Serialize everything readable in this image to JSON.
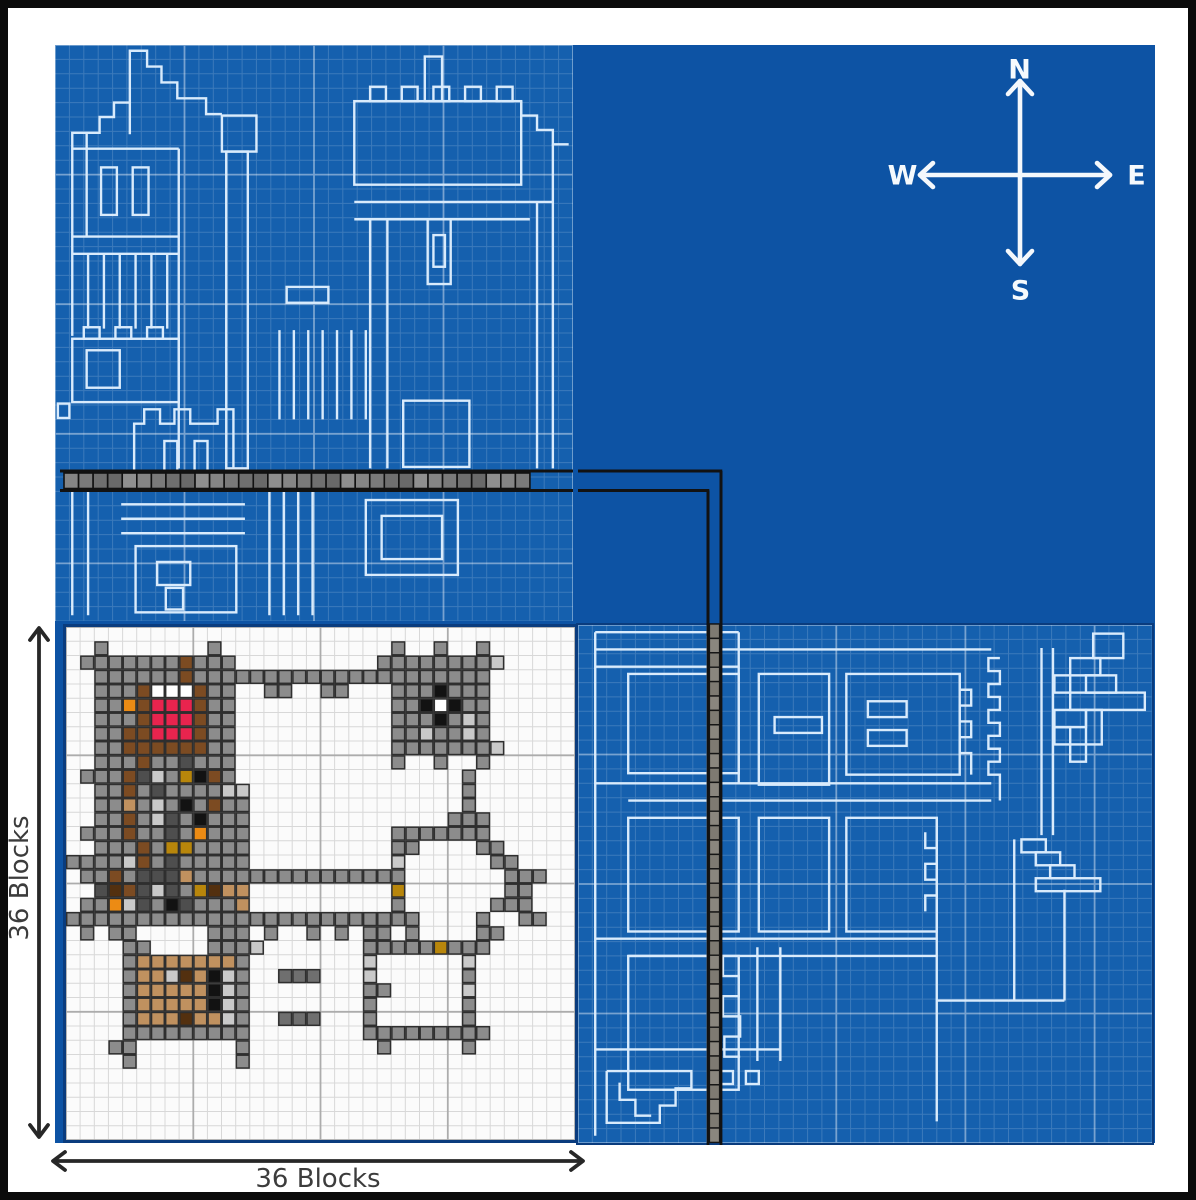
{
  "compass": {
    "north": "N",
    "east": "E",
    "south": "S",
    "west": "W"
  },
  "dimensions": {
    "left": "36 Blocks",
    "bottom": "36 Blocks"
  },
  "colors": {
    "frame": "#0b0b0b",
    "margin": "#ffffff",
    "canvas_blue": "#0d53a4",
    "panel_blue": "#1560ae",
    "grid_minor": "rgba(255,255,255,0.17)",
    "grid_major": "rgba(255,255,255,0.42)",
    "blueprint_line": "#d9ebfc",
    "panel_border": "#0a3c7e",
    "plan_bg": "#fbfbfb",
    "plan_grid_minor": "#d8d8d8",
    "plan_grid_major": "#acacac",
    "cell_outline": "#2f2f2f",
    "walkway_line": "#121212",
    "walkway_grays": [
      "#858585",
      "#6f6f6f",
      "#8f8f8f",
      "#7a7a7a",
      "#696969"
    ],
    "walkway_grays_v": [
      "#7e7a72",
      "#6e6a62",
      "#8a867e",
      "#76726a"
    ],
    "arrow": "#272727",
    "label_text": "#3c3c3c",
    "compass_stroke": "#f4f8fc"
  },
  "plan": {
    "cols": 36,
    "rows": 36,
    "major_every": 9,
    "palette": {
      "g": "#8c8c8c",
      "G": "#6f6f6f",
      "l": "#c9c9c9",
      "d": "#4e4e4e",
      "k": "#121212",
      "W": "#ffffff",
      "r": "#e8244e",
      "b": "#7c4b22",
      "m": "#53300f",
      "t": "#c0915f",
      "o": "#ec8b14",
      "y": "#b8860b"
    },
    "rows_map": [
      "....................................",
      "..g.......g............g..g..g......",
      ".gggggggbggg..........ggggggggl.....",
      "..ggggggbggggggggggggggggggggg......",
      "..gggbWWWbgg..gg..gg...gggkggg......",
      "..ggobrrrbgg...........ggkWkgg......",
      "..gggbrrrbgg...........gggkglg......",
      "..ggbbrrrbgg...........gglgglg......",
      "..ggbbbbbbgg...........gggggggl.....",
      "..gggbggdggg...........g..g..g......",
      ".gggbdlgykbg................g.......",
      "..ggbgdggggll...............g.......",
      "..ggtglgkgbgg...............g.......",
      "..ggbgldgkggg..............ggg......",
      ".gggbggdgoggg..........ggggggg......",
      "..gggbgyygggg..........gg....gg.....",
      "gggglbgdggggg..........l......gg....",
      ".ggbgdddtggggggggggggggg.......ggg..",
      "..dmbdldgymtt..........y.......gg...",
      ".ggoldgkdgggt..........g......ggg...",
      "ggggggggggggggggggggggggg....g..gg..",
      ".g.gg.....ggg.g..g.g.gg.g....gg.....",
      "....gg....gggl.......gggggyggg......",
      "....gtttttttg........l......l.......",
      "....gttlmtklg..GGG...l......g.......",
      "....gtttttklg........gg.....l.......",
      "....gtttttklg........g......g.......",
      "....gtttmttlg..GGG...g......g.......",
      "....ggggggggg........ggggggggg......",
      "...gg.......g.........g.....g.......",
      "....g.......g.......................",
      "....................................",
      "....................................",
      "....................................",
      "....................................",
      "...................................."
    ]
  },
  "walkway": {
    "horizontal_blocks": 32,
    "vertical_blocks": 36
  },
  "blueprint_top_left": {
    "cols": 36,
    "rows": 40,
    "major_every": 9,
    "shapes": [
      [
        "p",
        5.2,
        6.2,
        5.2,
        0.4,
        6.4,
        0.4,
        6.4,
        1.5,
        7.4,
        1.5,
        7.4,
        2.6,
        8.5,
        2.6,
        8.5,
        3.7,
        10.5,
        3.7,
        10.5,
        4.8,
        11.6,
        4.8
      ],
      [
        "p",
        5.2,
        4.0,
        4.1,
        4.0,
        4.1,
        5.0,
        3.1,
        5.0,
        3.1,
        6.1,
        1.2,
        6.1,
        1.2,
        20.2
      ],
      [
        "l",
        2.2,
        6.1,
        2.2,
        13.3
      ],
      [
        "l",
        1.2,
        7.2,
        8.6,
        7.2
      ],
      [
        "r",
        3.2,
        8.5,
        1.1,
        3.3
      ],
      [
        "r",
        5.4,
        8.5,
        1.1,
        3.3
      ],
      [
        "l",
        1.2,
        13.3,
        8.6,
        13.3
      ],
      [
        "l",
        1.2,
        14.5,
        8.6,
        14.5
      ],
      [
        "l",
        2.3,
        14.5,
        2.3,
        19.7
      ],
      [
        "l",
        3.4,
        14.5,
        3.4,
        19.7
      ],
      [
        "l",
        4.5,
        14.5,
        4.5,
        19.7
      ],
      [
        "l",
        5.6,
        14.5,
        5.6,
        19.7
      ],
      [
        "l",
        6.7,
        14.5,
        6.7,
        19.7
      ],
      [
        "l",
        7.8,
        14.5,
        7.8,
        19.7
      ],
      [
        "r",
        1.2,
        20.4,
        7.4,
        4.4
      ],
      [
        "r",
        2.2,
        21.2,
        2.3,
        2.6
      ],
      [
        "r",
        2.0,
        19.6,
        1.1,
        0.8
      ],
      [
        "r",
        4.2,
        19.6,
        1.1,
        0.8
      ],
      [
        "r",
        6.4,
        19.6,
        1.1,
        0.8
      ],
      [
        "l",
        8.6,
        7.2,
        8.6,
        29.4
      ],
      [
        "r",
        11.6,
        4.9,
        2.4,
        2.5
      ],
      [
        "r",
        11.9,
        7.4,
        1.5,
        22.0
      ],
      [
        "r",
        0.2,
        24.9,
        0.8,
        1.0
      ],
      [
        "p",
        5.5,
        29.6,
        5.5,
        26.3,
        6.2,
        26.3,
        6.2,
        25.3,
        7.3,
        25.3,
        7.3,
        26.3,
        8.3,
        26.3,
        8.3,
        25.3,
        9.4,
        25.3,
        9.4,
        26.3,
        11.3,
        26.3,
        11.3,
        25.3,
        12.4,
        25.3,
        12.4,
        29.6
      ],
      [
        "r",
        7.6,
        27.5,
        0.9,
        2.1
      ],
      [
        "r",
        9.7,
        27.5,
        0.9,
        2.1
      ],
      [
        "r",
        16.1,
        16.8,
        2.9,
        1.1
      ],
      [
        "l",
        15.6,
        19.8,
        15.6,
        26.0
      ],
      [
        "l",
        16.6,
        19.8,
        16.6,
        26.0
      ],
      [
        "l",
        17.6,
        19.8,
        17.6,
        26.0
      ],
      [
        "l",
        18.6,
        19.8,
        18.6,
        26.0
      ],
      [
        "l",
        19.6,
        19.8,
        19.6,
        26.0
      ],
      [
        "l",
        20.6,
        19.8,
        20.6,
        26.0
      ],
      [
        "l",
        21.6,
        19.8,
        21.6,
        26.0
      ],
      [
        "r",
        25.7,
        0.8,
        1.2,
        3.1
      ],
      [
        "r",
        20.8,
        3.9,
        11.6,
        5.8
      ],
      [
        "r",
        21.9,
        2.9,
        1.1,
        1.0
      ],
      [
        "r",
        24.1,
        2.9,
        1.1,
        1.0
      ],
      [
        "r",
        26.3,
        2.9,
        1.1,
        1.0
      ],
      [
        "r",
        28.5,
        2.9,
        1.1,
        1.0
      ],
      [
        "r",
        30.7,
        2.9,
        1.1,
        1.0
      ],
      [
        "p",
        32.4,
        3.9,
        32.4,
        4.9,
        33.5,
        4.9,
        33.5,
        5.9,
        34.6,
        5.9,
        34.6,
        6.9,
        35.7,
        6.9
      ],
      [
        "l",
        20.8,
        10.9,
        34.6,
        10.9
      ],
      [
        "l",
        20.8,
        12.1,
        33.0,
        12.1
      ],
      [
        "r",
        25.9,
        12.1,
        1.6,
        4.5
      ],
      [
        "r",
        26.3,
        13.2,
        0.8,
        2.2
      ],
      [
        "l",
        21.9,
        12.1,
        21.9,
        29.4
      ],
      [
        "l",
        23.1,
        12.1,
        23.1,
        29.4
      ],
      [
        "l",
        33.5,
        10.9,
        33.5,
        29.4
      ],
      [
        "l",
        34.6,
        6.9,
        34.6,
        29.4
      ],
      [
        "r",
        24.2,
        24.7,
        4.6,
        4.6
      ],
      [
        "l",
        1.2,
        30.9,
        1.2,
        39.6
      ],
      [
        "l",
        2.3,
        30.9,
        2.3,
        39.6
      ],
      [
        "l",
        4.6,
        31.9,
        13.2,
        31.9
      ],
      [
        "l",
        4.6,
        32.9,
        13.2,
        32.9
      ],
      [
        "l",
        4.6,
        33.9,
        13.2,
        33.9
      ],
      [
        "r",
        5.6,
        34.8,
        7.0,
        4.6
      ],
      [
        "r",
        7.1,
        35.9,
        2.3,
        1.6
      ],
      [
        "r",
        7.7,
        37.7,
        1.2,
        1.5
      ],
      [
        "l",
        14.9,
        30.9,
        14.9,
        39.6
      ],
      [
        "l",
        15.9,
        30.9,
        15.9,
        39.6
      ],
      [
        "l",
        16.9,
        30.9,
        16.9,
        39.6
      ],
      [
        "l",
        17.9,
        30.9,
        17.9,
        39.6
      ],
      [
        "r",
        21.6,
        31.6,
        6.4,
        5.2
      ],
      [
        "r",
        22.7,
        32.7,
        4.2,
        3.0
      ]
    ]
  },
  "blueprint_bottom_right": {
    "cols": 40,
    "rows": 36,
    "major_every": 9,
    "shapes": [
      [
        "l",
        1.2,
        0.5,
        1.2,
        35.5
      ],
      [
        "l",
        1.2,
        0.5,
        11.2,
        0.5
      ],
      [
        "l",
        1.2,
        1.7,
        28.8,
        1.7
      ],
      [
        "l",
        1.2,
        2.9,
        11.2,
        2.9
      ],
      [
        "r",
        3.5,
        3.4,
        7.7,
        6.9
      ],
      [
        "l",
        11.2,
        0.5,
        11.2,
        11.0
      ],
      [
        "r",
        12.6,
        3.4,
        4.9,
        7.7
      ],
      [
        "r",
        13.7,
        6.4,
        3.3,
        1.1
      ],
      [
        "r",
        18.7,
        3.4,
        7.9,
        7.0
      ],
      [
        "r",
        20.2,
        5.3,
        2.7,
        1.1
      ],
      [
        "r",
        20.2,
        7.3,
        2.7,
        1.1
      ],
      [
        "p",
        26.6,
        3.4,
        26.6,
        4.5,
        27.4,
        4.5,
        27.4,
        5.6,
        26.6,
        5.6,
        26.6,
        6.7,
        27.4,
        6.7,
        27.4,
        7.8,
        26.6,
        7.8,
        26.6,
        8.9,
        27.4,
        8.9,
        27.4,
        10.4
      ],
      [
        "l",
        1.2,
        11.0,
        28.8,
        11.0
      ],
      [
        "l",
        3.5,
        12.2,
        28.8,
        12.2
      ],
      [
        "r",
        3.5,
        13.4,
        7.7,
        7.9
      ],
      [
        "r",
        12.6,
        13.4,
        4.9,
        7.9
      ],
      [
        "r",
        18.7,
        13.4,
        6.3,
        7.9
      ],
      [
        "p",
        24.2,
        14.4,
        24.2,
        15.5,
        25.0,
        15.5,
        25.0,
        16.6,
        24.2,
        16.6,
        24.2,
        17.7,
        25.0,
        17.7,
        25.0,
        18.8,
        24.2,
        18.8,
        24.2,
        19.9
      ],
      [
        "l",
        1.2,
        21.8,
        25.0,
        21.8
      ],
      [
        "l",
        3.5,
        23.0,
        25.0,
        23.0
      ],
      [
        "r",
        3.5,
        23.0,
        7.7,
        9.3
      ],
      [
        "p",
        10.1,
        23.0,
        10.1,
        24.4,
        11.2,
        24.4,
        11.2,
        25.8,
        10.1,
        25.8,
        10.1,
        27.2,
        11.3,
        27.2,
        11.3,
        28.6,
        10.2,
        28.6,
        10.2,
        30.0,
        11.3,
        30.0
      ],
      [
        "l",
        12.5,
        22.4,
        12.5,
        30.3
      ],
      [
        "l",
        14.1,
        22.4,
        14.1,
        30.3
      ],
      [
        "l",
        1.2,
        29.5,
        14.1,
        29.5
      ],
      [
        "p",
        2.0,
        31.0,
        7.9,
        31.0,
        7.9,
        32.2,
        6.8,
        32.2,
        6.8,
        33.4,
        5.7,
        33.4,
        5.7,
        34.6,
        2.0,
        34.6,
        2.0,
        31.0
      ],
      [
        "p",
        2.9,
        31.8,
        2.9,
        33.0,
        4.0,
        33.0,
        4.0,
        34.1,
        5.1,
        34.1
      ],
      [
        "r",
        9.9,
        31.0,
        0.9,
        0.9
      ],
      [
        "r",
        11.7,
        31.0,
        0.9,
        0.9
      ],
      [
        "l",
        25.0,
        13.4,
        25.0,
        34.5
      ],
      [
        "l",
        25.0,
        26.1,
        33.9,
        26.1
      ],
      [
        "l",
        33.9,
        18.4,
        33.9,
        26.1
      ],
      [
        "p",
        29.4,
        2.3,
        28.6,
        2.3,
        28.6,
        3.2,
        29.4,
        3.2,
        29.4,
        4.1,
        28.6,
        4.1,
        28.6,
        5.0,
        29.4,
        5.0,
        29.4,
        5.9,
        28.6,
        5.9,
        28.6,
        6.8,
        29.4,
        6.8,
        29.4,
        7.7,
        28.6,
        7.7,
        28.6,
        8.6,
        29.4,
        8.6,
        29.4,
        9.5,
        28.6,
        9.5,
        28.6,
        10.4,
        29.4,
        10.4,
        29.4,
        12.2
      ],
      [
        "l",
        32.3,
        1.6,
        32.3,
        14.6
      ],
      [
        "l",
        33.1,
        1.6,
        33.1,
        14.6
      ],
      [
        "r",
        35.9,
        0.6,
        2.1,
        1.7
      ],
      [
        "r",
        34.3,
        2.3,
        2.1,
        1.2
      ],
      [
        "r",
        33.2,
        3.5,
        1.1,
        1.2
      ],
      [
        "r",
        35.4,
        3.5,
        2.1,
        1.2
      ],
      [
        "r",
        34.3,
        4.7,
        5.2,
        1.2
      ],
      [
        "r",
        33.2,
        5.9,
        2.2,
        1.2
      ],
      [
        "r",
        35.4,
        5.9,
        1.1,
        2.4
      ],
      [
        "r",
        33.2,
        7.1,
        1.1,
        1.2
      ],
      [
        "r",
        34.3,
        8.3,
        1.1,
        1.2
      ],
      [
        "r",
        30.9,
        14.9,
        1.7,
        0.9
      ],
      [
        "r",
        31.9,
        15.8,
        1.7,
        0.9
      ],
      [
        "r",
        32.9,
        16.7,
        1.7,
        0.9
      ],
      [
        "r",
        31.9,
        17.6,
        4.5,
        0.9
      ],
      [
        "l",
        30.4,
        14.9,
        30.4,
        26.1
      ]
    ]
  }
}
